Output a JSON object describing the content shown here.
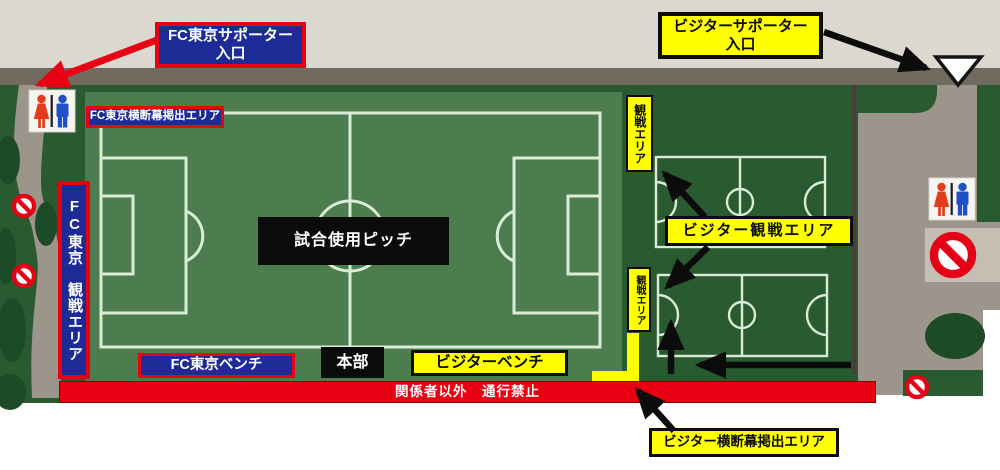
{
  "colors": {
    "beige": "#ddd8cf",
    "bar-gray": "#716a5e",
    "dark-green": "#2a5a30",
    "pitch-green": "#4d7d4e",
    "line-green": "#d9ecd8",
    "path-gray": "#9b958b",
    "light-gray": "#c4beb3",
    "bush-green": "#1d4a27",
    "red": "#ea0013",
    "navy": "#1c2b96",
    "yellow": "#ffff00",
    "ink": "#0c0c0c",
    "white": "#ffffff"
  },
  "map": {
    "fc_supporter_entrance": {
      "line1": "FC東京サポーター",
      "line2": "入口"
    },
    "visitor_supporter_entrance": {
      "line1": "ビジターサポーター",
      "line2": "入口"
    },
    "fc_banner_area_label": "FC東京横断幕掲出エリア",
    "fc_watch_area_label": "FC東京　観戦エリア",
    "match_pitch_label": "試合使用ピッチ",
    "fc_bench_label": "FC東京ベンチ",
    "headquarters_label": "本部",
    "visitor_bench_label": "ビジターベンチ",
    "restricted_label": "関係者以外　通行禁止",
    "watch_area_upper_label": "観戦エリア",
    "watch_area_lower_label": "観戦エリア",
    "visitor_watch_area_label": "ビジター観戦エリア",
    "visitor_banner_area_label": "ビジター横断幕掲出エリア"
  },
  "icons": {
    "restroom_left": "restroom-icon",
    "restroom_right": "restroom-icon",
    "no_entry_signs": "no-entry-icon",
    "visitor_entrance_marker": "triangle-down-icon"
  }
}
